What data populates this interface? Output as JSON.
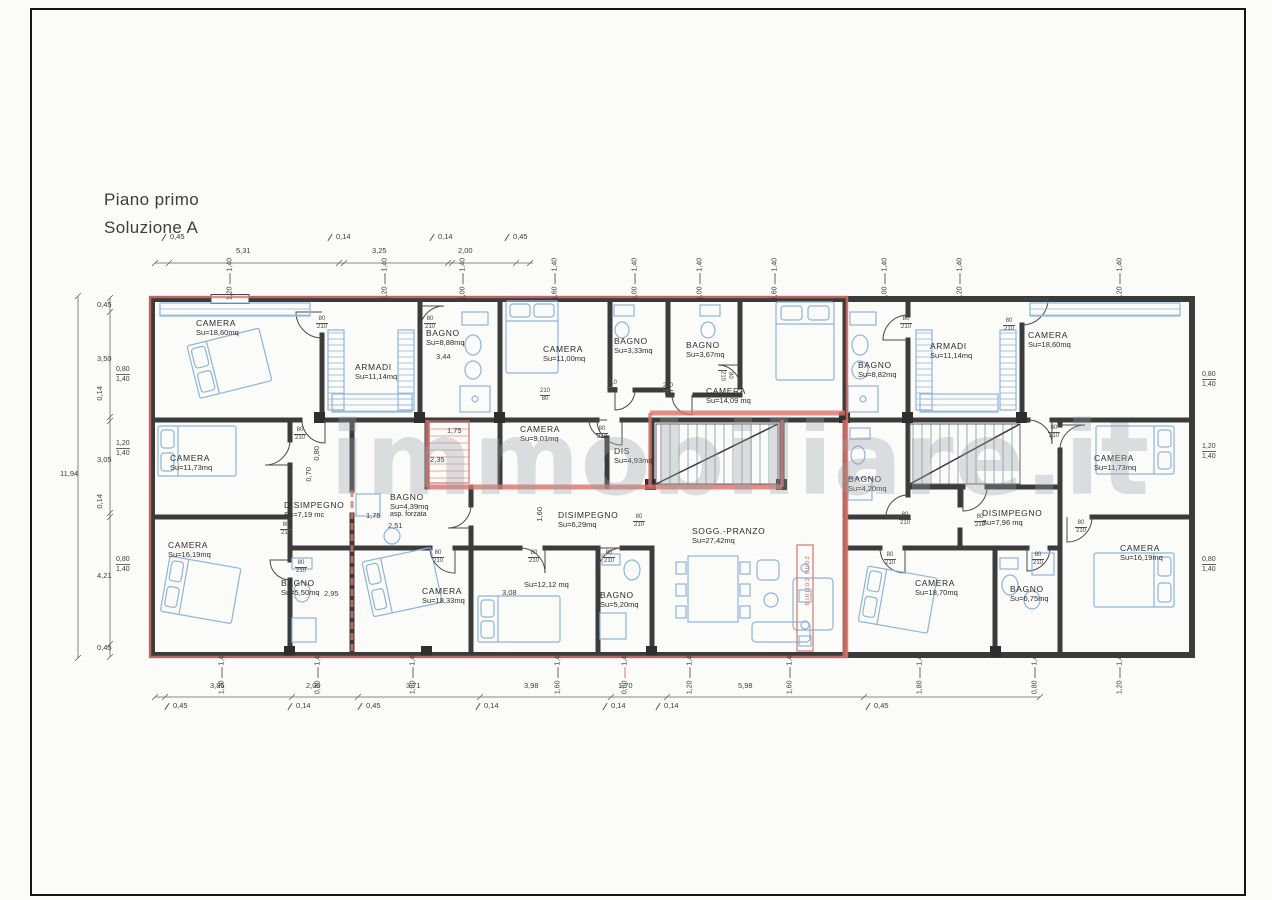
{
  "page": {
    "title_line1": "Piano primo",
    "title_line2": "Soluzione A",
    "watermark": "immobiliare.it"
  },
  "colors": {
    "red": "#d9736a",
    "wall": "#3b3b3b",
    "furniture": "#8fb4d9",
    "dimtext": "#3d3d3d",
    "watermark": "#9ba0a6",
    "paper": "#fbfbf9",
    "glass": "#7d9fc4"
  },
  "rooms": [
    {
      "name": "CAMERA",
      "area": "Su=18,60mq",
      "x": 196,
      "y": 318
    },
    {
      "name": "ARMADI",
      "area": "Su=11,14mq",
      "x": 355,
      "y": 362
    },
    {
      "name": "BAGNO",
      "area": "Su=8,88mq",
      "x": 426,
      "y": 328
    },
    {
      "name": "CAMERA",
      "area": "Su=11,00mq",
      "x": 543,
      "y": 344
    },
    {
      "name": "BAGNO",
      "area": "Su=3,33mq",
      "x": 614,
      "y": 336
    },
    {
      "name": "BAGNO",
      "area": "Su=3,67mq",
      "x": 686,
      "y": 340
    },
    {
      "name": "CAMERA",
      "area": "Su=14,09 mq",
      "x": 706,
      "y": 386
    },
    {
      "name": "BAGNO",
      "area": "Su=8,82mq",
      "x": 858,
      "y": 360
    },
    {
      "name": "ARMADI",
      "area": "Su=11,14mq",
      "x": 930,
      "y": 341
    },
    {
      "name": "CAMERA",
      "area": "Su=18,60mq",
      "x": 1028,
      "y": 330
    },
    {
      "name": "CAMERA",
      "area": "Su=11,73mq",
      "x": 170,
      "y": 453
    },
    {
      "name": "DISIMPEGNO",
      "area": "Su=7,19 mc",
      "x": 284,
      "y": 500
    },
    {
      "name": "CAMERA",
      "area": "Su=9,01mq",
      "x": 520,
      "y": 424
    },
    {
      "name": "DIS",
      "area": "Su=4,93mq",
      "x": 614,
      "y": 446
    },
    {
      "name": "BAGNO",
      "area": "Su=4,39mq",
      "extra": "asp. forzata",
      "x": 390,
      "y": 492
    },
    {
      "name": "DISIMPEGNO",
      "area": "Su=6,29mq",
      "x": 558,
      "y": 510
    },
    {
      "name": "SOGG.-PRANZO",
      "area": "Su=27,42mq",
      "x": 692,
      "y": 526
    },
    {
      "name": "BAGNO",
      "area": "Su=4,20mq",
      "x": 848,
      "y": 474
    },
    {
      "name": "DISIMPEGNO",
      "area": "Su=7,96 mq",
      "x": 982,
      "y": 508
    },
    {
      "name": "CAMERA",
      "area": "Su=11,73mq",
      "x": 1094,
      "y": 453
    },
    {
      "name": "CAMERA",
      "area": "Su=16,19mq",
      "x": 168,
      "y": 540
    },
    {
      "name": "BAGNO",
      "area": "Su=5,50mq",
      "x": 281,
      "y": 578
    },
    {
      "name": "CAMERA",
      "area": "Su=18,33mq",
      "x": 422,
      "y": 586
    },
    {
      "name": "",
      "area": "Su=12,12 mq",
      "x": 524,
      "y": 580
    },
    {
      "name": "BAGNO",
      "area": "Su=5,20mq",
      "x": 600,
      "y": 590
    },
    {
      "name": "CAMERA",
      "area": "Su=18,70mq",
      "x": 915,
      "y": 578
    },
    {
      "name": "BAGNO",
      "area": "Su=6,75mq",
      "x": 1010,
      "y": 584
    },
    {
      "name": "CAMERA",
      "area": "Su=16,19mq",
      "x": 1120,
      "y": 543
    },
    {
      "name": "zona cottura",
      "cls": "zona",
      "x": 803,
      "y": 556
    }
  ],
  "door_labels": [
    {
      "t": "80",
      "b": "210",
      "x": 316,
      "y": 316
    },
    {
      "t": "80",
      "b": "210",
      "x": 424,
      "y": 316
    },
    {
      "t": "80",
      "b": "210",
      "x": 718,
      "y": 370,
      "rot": true
    },
    {
      "t": "80",
      "b": "210",
      "x": 900,
      "y": 316
    },
    {
      "t": "80",
      "b": "210",
      "x": 1003,
      "y": 318
    },
    {
      "t": "80",
      "b": "210",
      "x": 294,
      "y": 427
    },
    {
      "t": "210",
      "b": "80",
      "x": 540,
      "y": 388
    },
    {
      "t": "210",
      "b": "80",
      "x": 607,
      "y": 380
    },
    {
      "t": "210",
      "b": "80",
      "x": 663,
      "y": 383
    },
    {
      "t": "80",
      "b": "210",
      "x": 596,
      "y": 426
    },
    {
      "t": "80",
      "b": "210",
      "x": 633,
      "y": 514
    },
    {
      "t": "80",
      "b": "210",
      "x": 603,
      "y": 550
    },
    {
      "t": "80",
      "b": "210",
      "x": 432,
      "y": 550
    },
    {
      "t": "80",
      "b": "210",
      "x": 528,
      "y": 550
    },
    {
      "t": "80",
      "b": "210",
      "x": 280,
      "y": 522
    },
    {
      "t": "80",
      "b": "210",
      "x": 295,
      "y": 560
    },
    {
      "t": "80",
      "b": "210",
      "x": 1048,
      "y": 425
    },
    {
      "t": "80",
      "b": "210",
      "x": 899,
      "y": 512
    },
    {
      "t": "80",
      "b": "210",
      "x": 974,
      "y": 514
    },
    {
      "t": "80",
      "b": "210",
      "x": 1075,
      "y": 520
    },
    {
      "t": "80",
      "b": "210",
      "x": 884,
      "y": 552
    },
    {
      "t": "80",
      "b": "210",
      "x": 1032,
      "y": 552
    }
  ],
  "dims": {
    "top": [
      {
        "t": "0,45",
        "x": 160,
        "y": 232,
        "callout": true
      },
      {
        "t": "5,31",
        "x": 236,
        "y": 246
      },
      {
        "t": "0,14",
        "x": 326,
        "y": 232,
        "callout": true
      },
      {
        "t": "3,25",
        "x": 372,
        "y": 246
      },
      {
        "t": "0,14",
        "x": 428,
        "y": 232,
        "callout": true
      },
      {
        "t": "2,00",
        "x": 458,
        "y": 246
      },
      {
        "t": "0,45",
        "x": 503,
        "y": 232,
        "callout": true
      }
    ],
    "left": [
      {
        "t": "0,45",
        "x": 97,
        "y": 300
      },
      {
        "t": "3,50",
        "x": 97,
        "y": 354
      },
      {
        "t": "0,14",
        "x": 95,
        "y": 386,
        "rot": true
      },
      {
        "t": "3,05",
        "x": 97,
        "y": 455
      },
      {
        "t": "0,14",
        "x": 95,
        "y": 494,
        "rot": true
      },
      {
        "t": "4,21",
        "x": 97,
        "y": 571
      },
      {
        "t": "0,45",
        "x": 97,
        "y": 643
      },
      {
        "t": "11,94",
        "x": 60,
        "y": 469
      }
    ],
    "top_windows": [
      {
        "a": "1,20",
        "b": "1,40",
        "x": 230,
        "y": 279,
        "w": 38
      },
      {
        "a": "1,20",
        "b": "1,40",
        "x": 385,
        "y": 279,
        "w": 38
      },
      {
        "a": "1,00",
        "b": "1,40",
        "x": 463,
        "y": 279,
        "w": 30
      },
      {
        "a": "1,60",
        "b": "1,40",
        "x": 555,
        "y": 279,
        "w": 48
      },
      {
        "a": "1,00",
        "b": "1,40",
        "x": 635,
        "y": 279,
        "w": 30
      },
      {
        "a": "1,00",
        "b": "1,40",
        "x": 700,
        "y": 279,
        "w": 30
      },
      {
        "a": "1,60",
        "b": "1,40",
        "x": 775,
        "y": 279,
        "w": 48
      },
      {
        "a": "1,00",
        "b": "1,40",
        "x": 885,
        "y": 279,
        "w": 30
      },
      {
        "a": "1,20",
        "b": "1,40",
        "x": 960,
        "y": 279,
        "w": 38
      },
      {
        "a": "1,20",
        "b": "1,40",
        "x": 1120,
        "y": 279,
        "w": 38
      }
    ],
    "bottom_windows": [
      {
        "a": "1,20",
        "b": "1,40",
        "x": 222,
        "y": 673,
        "w": 38
      },
      {
        "a": "0,80",
        "b": "1,40",
        "x": 318,
        "y": 673,
        "w": 26
      },
      {
        "a": "1,80",
        "b": "1,40",
        "x": 413,
        "y": 673,
        "w": 54
      },
      {
        "a": "1,60",
        "b": "1,40",
        "x": 558,
        "y": 673,
        "w": 48
      },
      {
        "a": "0,80",
        "b": "1,40",
        "x": 625,
        "y": 673,
        "w": 26,
        "red": true
      },
      {
        "a": "1,20",
        "b": "1,40",
        "x": 690,
        "y": 673,
        "w": 38
      },
      {
        "a": "1,60",
        "b": "1,40",
        "x": 790,
        "y": 673,
        "w": 48
      },
      {
        "a": "1,80",
        "b": "1,40",
        "x": 920,
        "y": 673,
        "w": 54
      },
      {
        "a": "0,80",
        "b": "1,40",
        "x": 1035,
        "y": 673,
        "w": 26
      },
      {
        "a": "1,20",
        "b": "1,40",
        "x": 1120,
        "y": 673,
        "w": 38
      }
    ],
    "left_windows": [
      {
        "a": "0,80",
        "b": "1,40",
        "x": 116,
        "y": 366,
        "h": 26
      },
      {
        "a": "1,20",
        "b": "1,40",
        "x": 116,
        "y": 440,
        "h": 38
      },
      {
        "a": "0,80",
        "b": "1,40",
        "x": 116,
        "y": 556,
        "h": 26
      }
    ],
    "right_windows": [
      {
        "a": "0,80",
        "b": "1,40",
        "x": 1202,
        "y": 371,
        "h": 26
      },
      {
        "a": "1,20",
        "b": "1,40",
        "x": 1202,
        "y": 443,
        "h": 38
      },
      {
        "a": "0,80",
        "b": "1,40",
        "x": 1202,
        "y": 556,
        "h": 26
      }
    ],
    "bottom": [
      {
        "t": "3,85",
        "x": 210,
        "y": 681
      },
      {
        "t": "2,00",
        "x": 306,
        "y": 681
      },
      {
        "t": "3,71",
        "x": 406,
        "y": 681
      },
      {
        "t": "3,98",
        "x": 524,
        "y": 681
      },
      {
        "t": "1,70",
        "x": 618,
        "y": 681
      },
      {
        "t": "5,98",
        "x": 738,
        "y": 681
      }
    ],
    "bottom_callouts": [
      {
        "t": "0,45",
        "x": 163,
        "y": 701,
        "callout": true
      },
      {
        "t": "0,14",
        "x": 286,
        "y": 701,
        "callout": true
      },
      {
        "t": "0,45",
        "x": 356,
        "y": 701,
        "callout": true
      },
      {
        "t": "0,14",
        "x": 474,
        "y": 701,
        "callout": true
      },
      {
        "t": "0,14",
        "x": 601,
        "y": 701,
        "callout": true
      },
      {
        "t": "0,14",
        "x": 654,
        "y": 701,
        "callout": true
      },
      {
        "t": "0,45",
        "x": 864,
        "y": 701,
        "callout": true
      }
    ],
    "interior": [
      {
        "t": "3,44",
        "x": 436,
        "y": 352
      },
      {
        "t": "1,75",
        "x": 447,
        "y": 426
      },
      {
        "t": "2,35",
        "x": 430,
        "y": 455
      },
      {
        "t": "1,75",
        "x": 366,
        "y": 511
      },
      {
        "t": "2,51",
        "x": 388,
        "y": 521
      },
      {
        "t": "2,95",
        "x": 324,
        "y": 589
      },
      {
        "t": "3,08",
        "x": 502,
        "y": 588
      },
      {
        "t": "0,80",
        "x": 312,
        "y": 446,
        "rot": true
      },
      {
        "t": "0,70",
        "x": 304,
        "y": 467,
        "rot": true
      },
      {
        "t": "1,60",
        "x": 535,
        "y": 507,
        "rot": true
      }
    ]
  }
}
